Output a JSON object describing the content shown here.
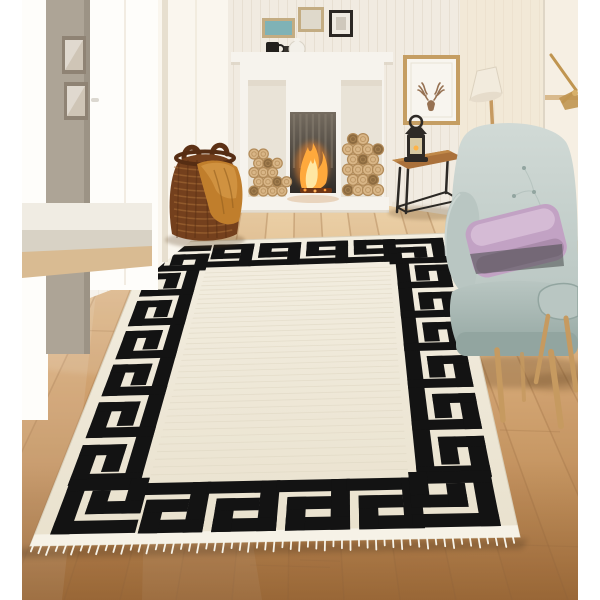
{
  "scene": {
    "title": "Living room product photo: cream rug with black Greek key border, fireplace, wicker basket and teal wingback armchair",
    "type": "product-photo",
    "visible_text": "none"
  },
  "palette": {
    "page": "#ffffff",
    "wall": "#f1ebe1",
    "panelLine": "#ded5c5",
    "wallWarm": "#f3e6cd",
    "doorWall": "#f6efe3",
    "pillar": "#ada496",
    "pillarEdge": "#948b7d",
    "frameMetal": "#8f8374",
    "frameGlass": "#cfc5b6",
    "windowWhite": "#fefdfa",
    "windowFrame": "#e3dac8",
    "sill": "#f0ece3",
    "sillFace": "#d8d2c5",
    "stepWood": "#d9bb92",
    "baseboard": "#eae2d4",
    "junctionShadow": "#c2ab8b",
    "floorTop": "#ecd2a9",
    "floorMid": "#d4a775",
    "floorBottom": "#b07c46",
    "plank": "#a3764a",
    "fpWhite": "#f6f3ed",
    "fpShadow": "#ded6c7",
    "alcove": "#e9e3d7",
    "logFace": "#d9b687",
    "logRing": "#b28b59",
    "logDark": "#8d6b40",
    "boxTop": "#756c60",
    "boxBottom": "#2f2b27",
    "fireStreak": "#8a8173",
    "fireGlow": "#ff8c2a",
    "fireMid": "#ffa93c",
    "fireCore": "#ffeaa9",
    "ember": "#6e3514",
    "mugBlack": "#23201d",
    "potWhite": "#f3f0e9",
    "frameTan": "#c3ac82",
    "artTeal": "#7fb2b6",
    "artPale": "#dfd9cb",
    "frameBlack": "#2b2723",
    "deerFrame": "#c59e63",
    "deerMat": "#f8f5ef",
    "antler": "#967152",
    "tableWood": "#aa713b",
    "tableWoodLight": "#c08949",
    "metal": "#2c2925",
    "lantern": "#2e2a26",
    "lanternGlass": "#d8c9a3",
    "basket": "#74401d",
    "basketDark": "#562d13",
    "basketLight": "#a96f39",
    "throw": "#c07e2c",
    "throwLight": "#d69a47",
    "throwDark": "#95601f",
    "legWood": "#c69a60",
    "brass": "#c09550",
    "chair": "#b9c6c2",
    "chairLight": "#d1dad6",
    "chairDark": "#92a5a0",
    "pillow": "#c2a2c4",
    "pillowLight": "#d9c2da",
    "pillowDark": "#a183a3",
    "shadow": "#5a3c1e",
    "rugField": "#f3eee1",
    "rugFieldLow": "#e9e1cd",
    "rugPattern": "#131313",
    "rugEdge": "#d9d0bb",
    "rugBinding": "#f6f2e7",
    "fringe": "#f7f4ea",
    "striation": "#ded6c2"
  },
  "rug": {
    "pattern": "greek-key-meander",
    "field_color": "#f3eee1",
    "pattern_color": "#131313",
    "fringe_color": "#f7f4ea",
    "border_units_top": 4,
    "border_units_bottom": 4,
    "border_units_side": 6,
    "corner_motifs": 4,
    "has_bottom_fringe": true
  },
  "objects": [
    {
      "name": "greek-key-rug",
      "label": "Cream rug with black Greek key border and white fringe"
    },
    {
      "name": "fireplace",
      "label": "White mantel fireplace with burning fire"
    },
    {
      "name": "log-stack-left",
      "label": "Stacked firewood in left alcove"
    },
    {
      "name": "log-stack-right",
      "label": "Stacked firewood beside firebox"
    },
    {
      "name": "storage-basket",
      "label": "Brown wicker basket"
    },
    {
      "name": "throw-blanket",
      "label": "Mustard throw draped over basket"
    },
    {
      "name": "armchair",
      "label": "Grey-teal tufted wingback armchair with wooden legs"
    },
    {
      "name": "lilac-pillow",
      "label": "Lilac velvet cushion"
    },
    {
      "name": "stool",
      "label": "Small grey stool with wooden legs"
    },
    {
      "name": "side-table",
      "label": "Wood-top side table with black metal frame"
    },
    {
      "name": "lantern",
      "label": "Black candle lantern"
    },
    {
      "name": "deer-art",
      "label": "Framed antler print"
    },
    {
      "name": "mantel-frames",
      "label": "Three small picture frames above mantel"
    },
    {
      "name": "mantel-mug",
      "label": "Black mug on mantel"
    },
    {
      "name": "mantel-teapot",
      "label": "White teapot on mantel"
    },
    {
      "name": "floor-lamp",
      "label": "Floor lamp with cream shade"
    },
    {
      "name": "brass-wall-lamp",
      "label": "Brass lamp arm, top right"
    },
    {
      "name": "pillar-frames",
      "label": "Two frames on grey pillar"
    },
    {
      "name": "window-light",
      "label": "Bright window light, left side"
    },
    {
      "name": "wood-floor",
      "label": "Light oak plank floor"
    }
  ]
}
